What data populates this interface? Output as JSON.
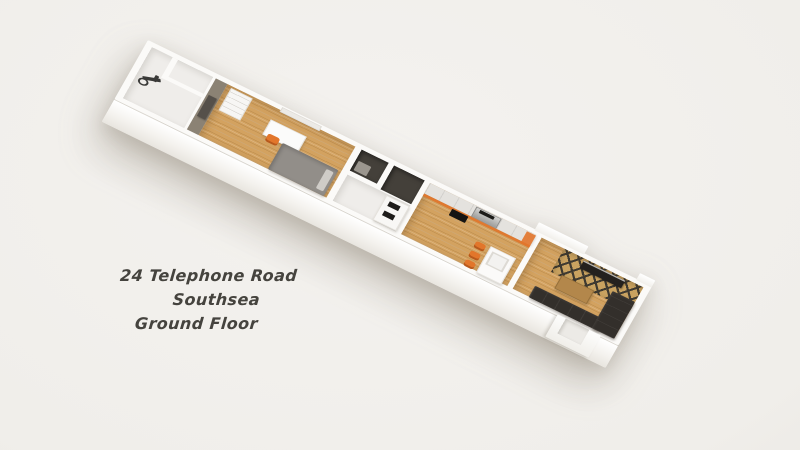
{
  "caption": {
    "line1": "24 Telephone Road",
    "line2": "Southsea",
    "line3": "Ground Floor"
  },
  "palette": {
    "background": "#f0eeea",
    "wall_white": "#fbfaf8",
    "floor_light": "#efedea",
    "wood_floor": "#d3a260",
    "accent_orange": "#e2762b",
    "accent_wall_gray": "#8b8274",
    "door_dark": "#55504a",
    "bed_gray": "#928e89",
    "sofa_dark": "#332f2b",
    "bath_floor_dark": "#44403a",
    "cabinet_gray": "#e4e2de",
    "table_wood": "#b3874b",
    "chevron_tan": "#c9a260",
    "chevron_dark": "#3f3a31",
    "text_color": "#45433e"
  },
  "floorplan": {
    "render_style": "3d-angled-floorplan",
    "rooms": [
      "storage-exercise-room",
      "bedroom",
      "hallway-bathrooms",
      "kitchen",
      "living-room",
      "entrance-vestibule"
    ]
  }
}
